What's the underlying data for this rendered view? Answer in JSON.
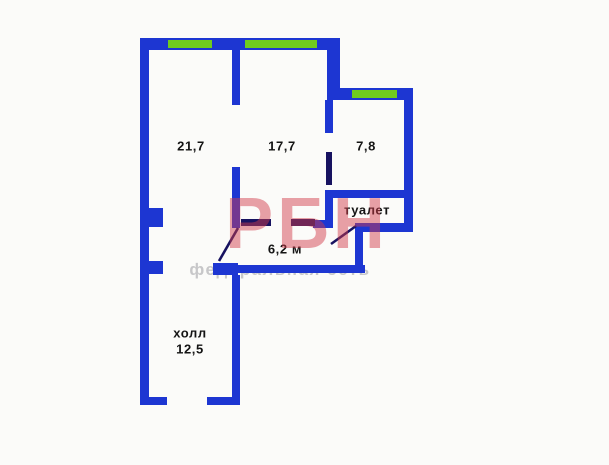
{
  "watermark": {
    "brand": "РБН",
    "subtitle": "федеральная сеть"
  },
  "rooms": {
    "room_left": {
      "area": "21,7"
    },
    "room_middle": {
      "area": "17,7"
    },
    "room_right": {
      "area": "7,8"
    },
    "toilet": {
      "label": "туалет"
    },
    "corridor": {
      "area": "6,2 м"
    },
    "hall": {
      "label": "холл",
      "area": "12,5"
    }
  },
  "colors": {
    "wall": "#1d36d2",
    "window": "#6fcb1f",
    "door": "#171260",
    "label": "#141414",
    "watermark": "#d23c4c",
    "subtitle": "#c7c7c9",
    "background": "#fbfbf9"
  }
}
